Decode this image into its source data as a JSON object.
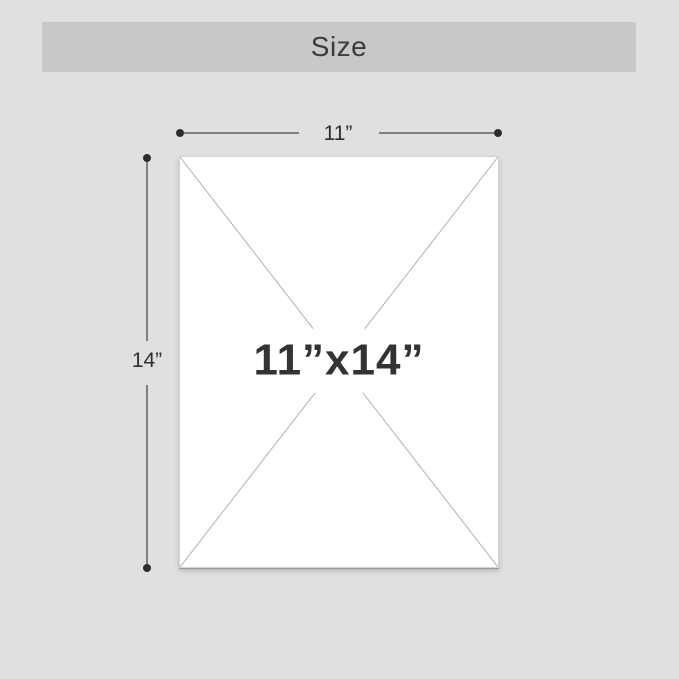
{
  "header": {
    "title": "Size"
  },
  "diagram": {
    "width_label": "11”",
    "height_label": "14”",
    "size_label": "11”x14”"
  },
  "colors": {
    "page_bg": "#e0e0e0",
    "header_bg": "#c8c8c8",
    "header_text": "#3c3c3c",
    "dimension_line": "#7f7f7f",
    "dimension_dot": "#2d2d2d",
    "dimension_text": "#2f2f2f",
    "placeholder_fill": "#ffffff",
    "placeholder_border": "#d4d4d4",
    "diagonal": "#b0b0b0",
    "size_text": "#333333"
  }
}
